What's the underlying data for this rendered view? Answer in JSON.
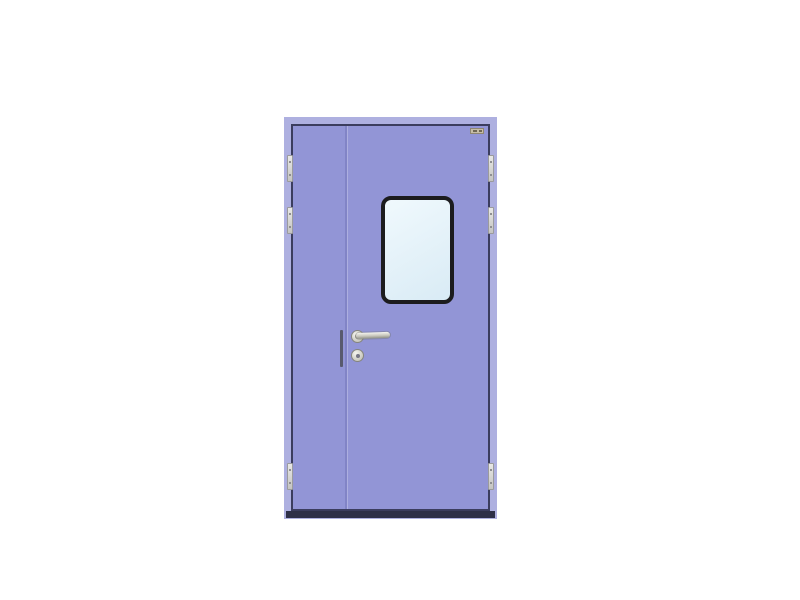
{
  "scene": {
    "type": "product-illustration",
    "subject": "Cleanroom unequal double-leaf steel door, periwinkle finish, with rounded vision window, stainless lever handle, cylinder lock, three hinges per side and dark threshold, on plain white background",
    "visible_text": [],
    "colors": {
      "bg": "#ffffff",
      "frame": "#aeb0e0",
      "leaf": "#9295d6",
      "gapline": "#3b3d5e",
      "meeting": "#8184c6",
      "threshold": "#2e3048",
      "winframe": "#1c1c1e",
      "glass1": "#f0f9fd",
      "glass2": "#d9ebf5",
      "metal1": "#f4f4ee",
      "metal2": "#c9c8be",
      "metal3": "#8f9086",
      "hinge1": "#e8e8e6",
      "hinge2": "#c4c4c2",
      "sticker": "#c6bda6",
      "lockbar": "#585a6e"
    },
    "door": {
      "leaves": [
        "inactive-narrow-leaf",
        "active-wide-leaf"
      ],
      "hinges": {
        "per_side": 3,
        "tops": [
          38,
          90,
          346
        ]
      },
      "window": {
        "shape": "rounded-rectangle",
        "location": "upper active leaf, centered"
      },
      "hardware": [
        "lever-handle",
        "cylinder-lock",
        "brand-label",
        "lock-edge-plate"
      ]
    }
  }
}
